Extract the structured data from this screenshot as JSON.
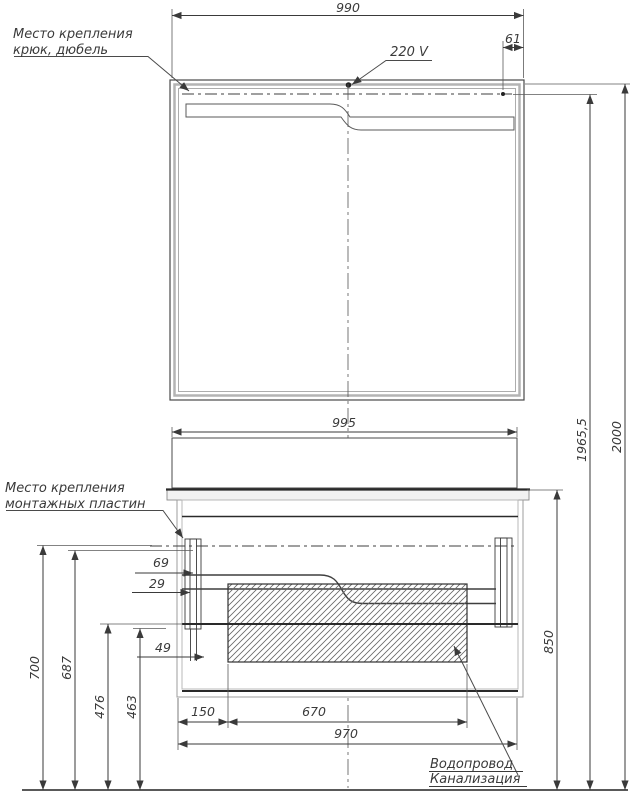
{
  "notes": {
    "hook": {
      "line1": "Место крепления",
      "line2": "крюк, дюбель"
    },
    "plates": {
      "line1": "Место крепления",
      "line2": "монтажных пластин"
    },
    "plumbing": {
      "line1": "Водопровод",
      "line2": "Канализация"
    },
    "voltage": "220 V"
  },
  "dims": {
    "mirror_width": "990",
    "hook_offset": "61",
    "total_height": "2000",
    "hook_height": "1965,5",
    "cabinet_width": "995",
    "plate_offset_top": "69",
    "plate_offset_mid": "29",
    "plate_offset_bottom": "49",
    "mount_height_outer": "700",
    "mount_height_inner": "687",
    "drain_height_outer": "476",
    "drain_height_inner": "463",
    "counter_height": "850",
    "basin_left_offset": "150",
    "basin_width": "670",
    "cabinet_bottom_width": "970"
  },
  "colors": {
    "line": "#3a3a3a",
    "frame_gray": "#b4b4b4",
    "background": "#ffffff"
  }
}
